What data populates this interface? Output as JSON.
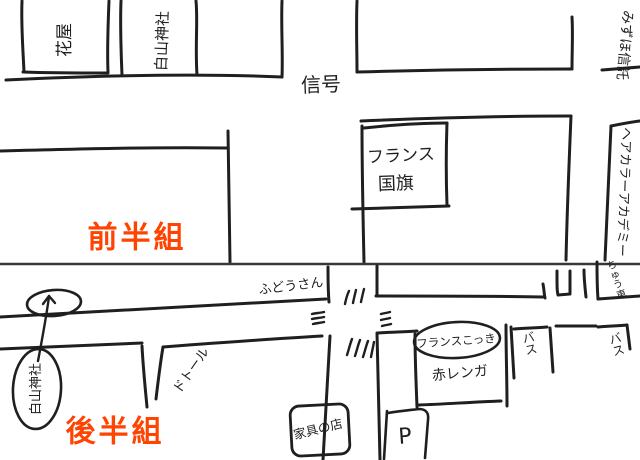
{
  "title": "hand-drawn route maps",
  "colors": {
    "background": "#ffffff",
    "ink": "#1f1f1f",
    "accent": "#ff4300",
    "divider": "#383838"
  },
  "top_map": {
    "group_label": "前半組",
    "flower_shop": "花屋",
    "shrine": "白山神社",
    "signal": "信号",
    "mizuho_trust": "みずほ信託",
    "france_flag_line1": "フランス",
    "france_flag_line2": "国旗",
    "hair_academy": "ヘアカラーアカデミー"
  },
  "bottom_map": {
    "group_label": "後半組",
    "real_estate": "ふどうさん",
    "shrine": "白山神社",
    "coffee_shop": "ドトール",
    "france_flag": "フランスこっき",
    "red_brick": "赤レンガ",
    "furniture_shop": "家具の店",
    "parking_mark": "P",
    "parking_note": "ちゅう車",
    "bus_stop_left": "バス",
    "bus_stop_right": "バス"
  }
}
